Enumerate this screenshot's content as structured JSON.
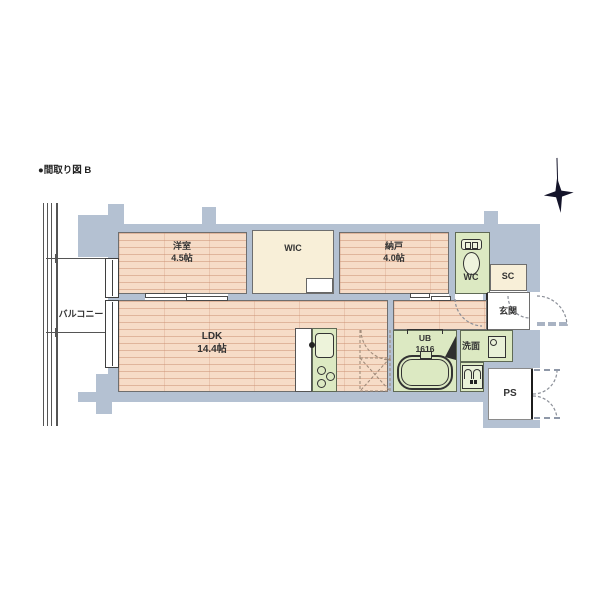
{
  "title": "●間取り図 B",
  "plan": {
    "compass": {
      "icon": "north-star-icon"
    },
    "rooms": {
      "balcony": {
        "label": "バルコニー"
      },
      "yoshitsu": {
        "name": "洋室",
        "size": "4.5帖"
      },
      "wic": {
        "label": "WIC"
      },
      "nando": {
        "name": "納戸",
        "size": "4.0帖"
      },
      "wc": {
        "label": "WC"
      },
      "sc": {
        "label": "SC"
      },
      "genkan": {
        "label": "玄関"
      },
      "ldk": {
        "name": "LDK",
        "size": "14.4帖"
      },
      "ub": {
        "name": "UB",
        "size": "1616"
      },
      "senmen": {
        "label": "洗面"
      },
      "ps": {
        "label": "PS"
      }
    },
    "colors": {
      "wood_floor": "#f6dcc7",
      "wood_plank_line": "#c98e70",
      "closet_cream": "#f8efd8",
      "wet_area_green": "#dce9c2",
      "wall_gray": "#b4c1d2",
      "outline": "#555555",
      "compass_black": "#14142a"
    },
    "icons": [
      "north-star-icon",
      "toilet-icon",
      "bathtub-icon",
      "kitchen-sink-icon",
      "stove-icon",
      "washing-machine-icon",
      "vanity-icon",
      "refrigerator-space-x",
      "door-swing-arc"
    ]
  }
}
